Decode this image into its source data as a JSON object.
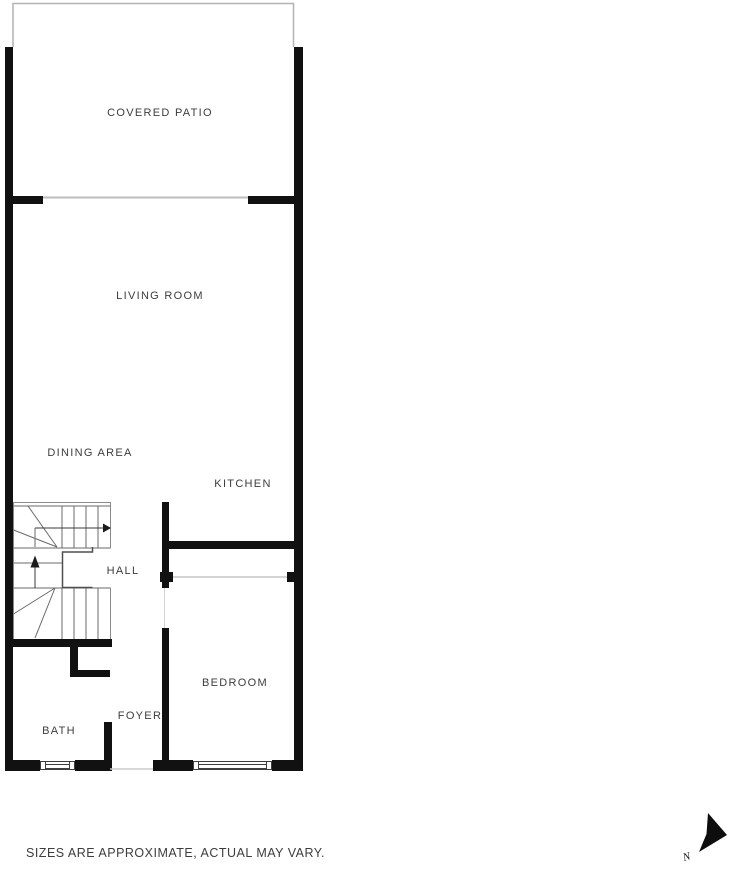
{
  "floorplan": {
    "rooms": [
      {
        "name": "COVERED PATIO"
      },
      {
        "name": "LIVING ROOM"
      },
      {
        "name": "DINING AREA"
      },
      {
        "name": "KITCHEN"
      },
      {
        "name": "HALL"
      },
      {
        "name": "BEDROOM"
      },
      {
        "name": "FOYER"
      },
      {
        "name": "BATH"
      }
    ],
    "disclaimer": "SIZES ARE APPROXIMATE, ACTUAL MAY VARY.",
    "compass": {
      "label": "N"
    },
    "colors": {
      "wall": "#111111",
      "thin_line": "#b5b5b5",
      "stair_line": "#6a6a6a",
      "arrow": "#1a1a1a",
      "text": "#3d3d3d",
      "background": "#ffffff"
    }
  }
}
